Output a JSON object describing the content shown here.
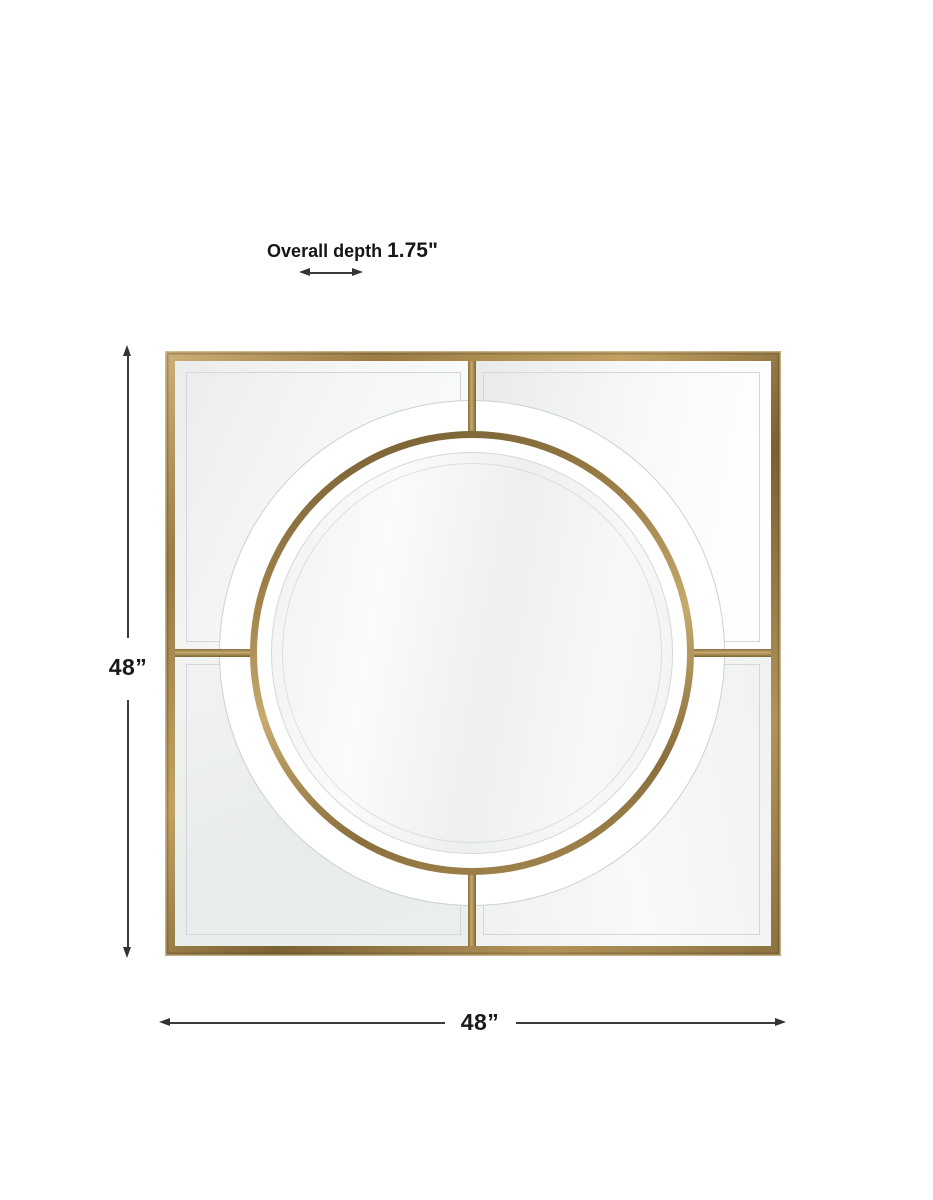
{
  "canvas": {
    "width": 933,
    "height": 1200,
    "background": "#ffffff"
  },
  "annotations": {
    "depth": {
      "label": "Overall depth",
      "value": "1.75\""
    },
    "height": {
      "value": "48”"
    },
    "width": {
      "value": "48”"
    }
  },
  "colors": {
    "gold_dark": "#6f5931",
    "gold_mid": "#a3854c",
    "gold_light": "#c7aa6e",
    "dimension_line": "#3b3b3b",
    "label_text": "#1a1a1a",
    "bevel_line": "#d3d8d5",
    "panel_tint": "#eef1f0",
    "background": "#ffffff"
  }
}
